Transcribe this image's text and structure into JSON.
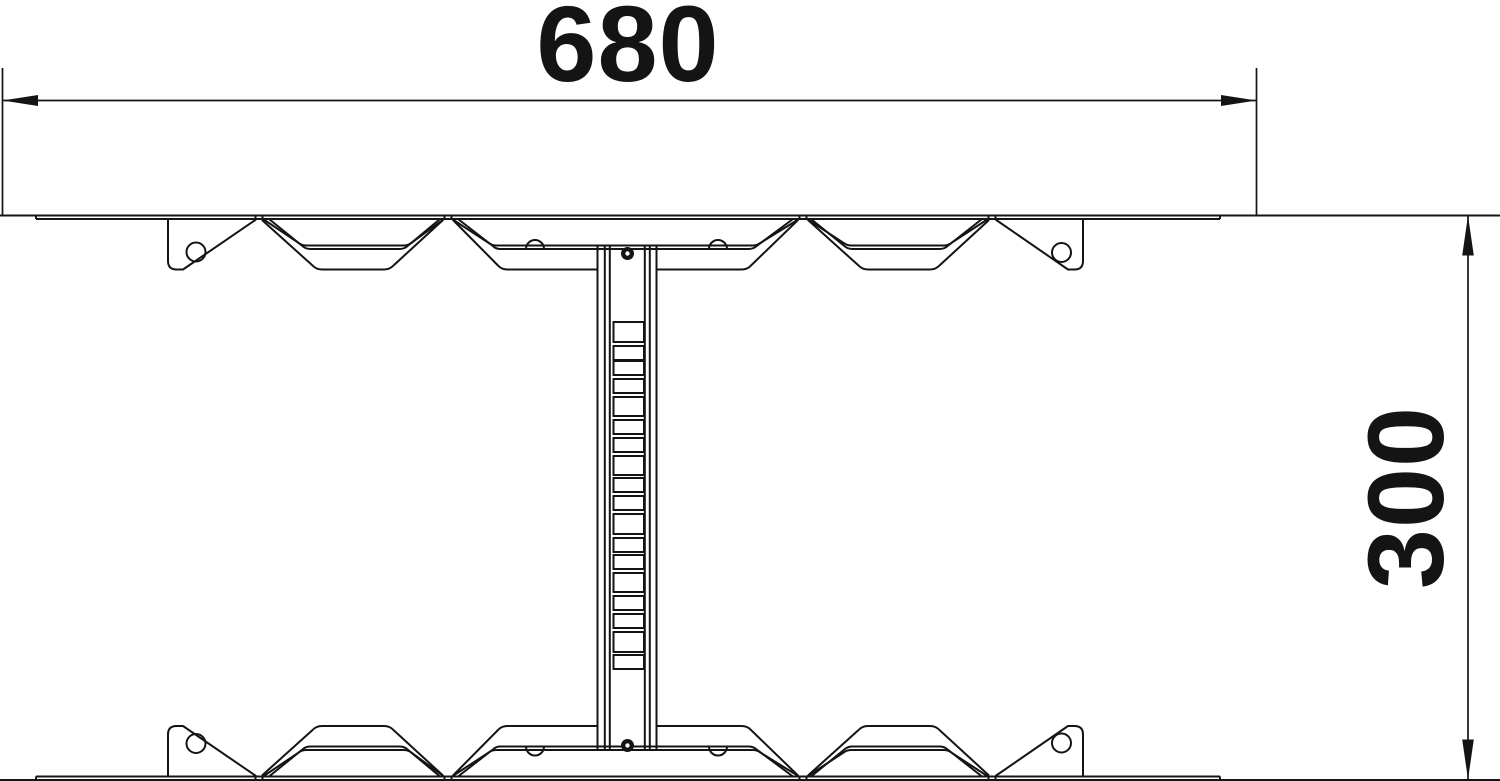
{
  "title": "Dimension drawing",
  "dimensions": {
    "width": {
      "value": "680"
    },
    "height": {
      "value": "300"
    }
  },
  "drawing": {
    "line_color": "#141414",
    "rung_slots": [
      [
        322,
        342
      ],
      [
        346,
        360
      ],
      [
        361,
        375
      ],
      [
        379,
        393
      ],
      [
        397,
        416
      ],
      [
        420,
        434
      ],
      [
        438,
        452
      ],
      [
        456,
        475
      ],
      [
        478,
        492
      ],
      [
        496,
        510
      ],
      [
        514,
        534
      ],
      [
        538,
        552
      ],
      [
        555,
        569
      ],
      [
        573,
        592
      ],
      [
        596,
        610
      ],
      [
        614,
        628
      ],
      [
        632,
        652
      ],
      [
        655,
        669
      ]
    ],
    "slot_x": 613.5,
    "slot_w": 30.5,
    "flange_holes": [
      [
        196,
        252
      ],
      [
        1061.5,
        252.5
      ]
    ],
    "hole_radius": 9.5,
    "notches": [
      535,
      718
    ],
    "notch_radius": 9,
    "bolts": [
      [
        627.5,
        253.5
      ],
      [
        627.5,
        745.5
      ]
    ],
    "bolt_radius": 6.5
  }
}
